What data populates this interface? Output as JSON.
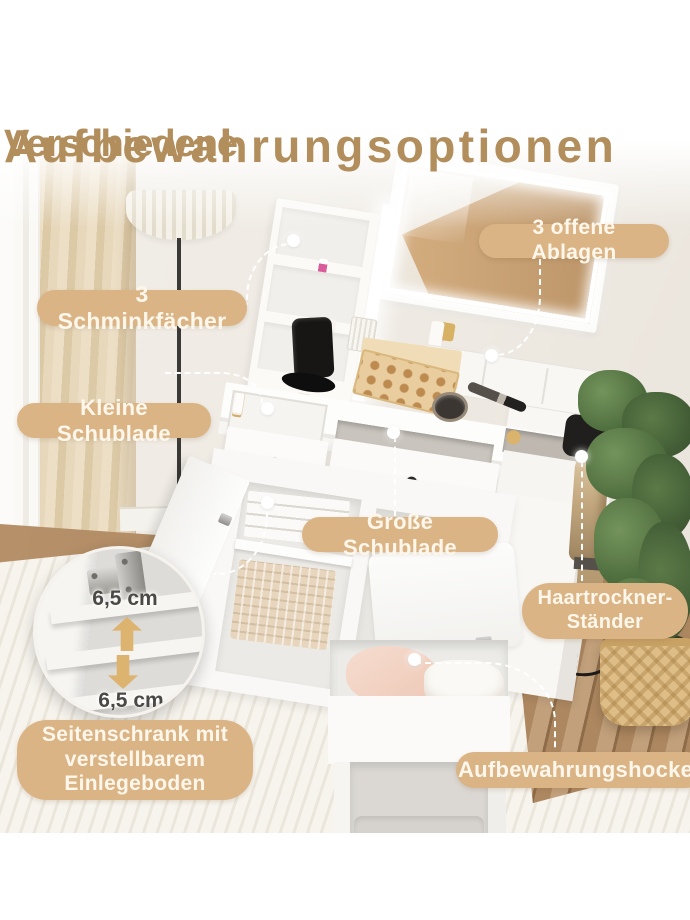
{
  "title": {
    "line1": "Verschiedene",
    "line2": "Aufbewahrungsoptionen"
  },
  "callouts": {
    "makeup_compartments": "3 Schminkfächer",
    "open_shelves": "3 offene Ablagen",
    "small_drawer": "Kleine Schublade",
    "large_drawer": "Große Schublade",
    "hairdryer_stand": "Haartrockner-Ständer",
    "side_cabinet": "Seitenschrank mit verstellbarem Einlegeboden",
    "storage_stool": "Aufbewahrungshocker"
  },
  "detail_inset": {
    "top_measurement": "6,5 cm",
    "bottom_measurement": "6,5 cm"
  },
  "colors": {
    "title_text": "#b28e5c",
    "pill_bg": "#dbb486",
    "pill_text": "#fdf7eb",
    "measure_arrow": "#dcb36f",
    "measure_text": "#4b4945"
  }
}
